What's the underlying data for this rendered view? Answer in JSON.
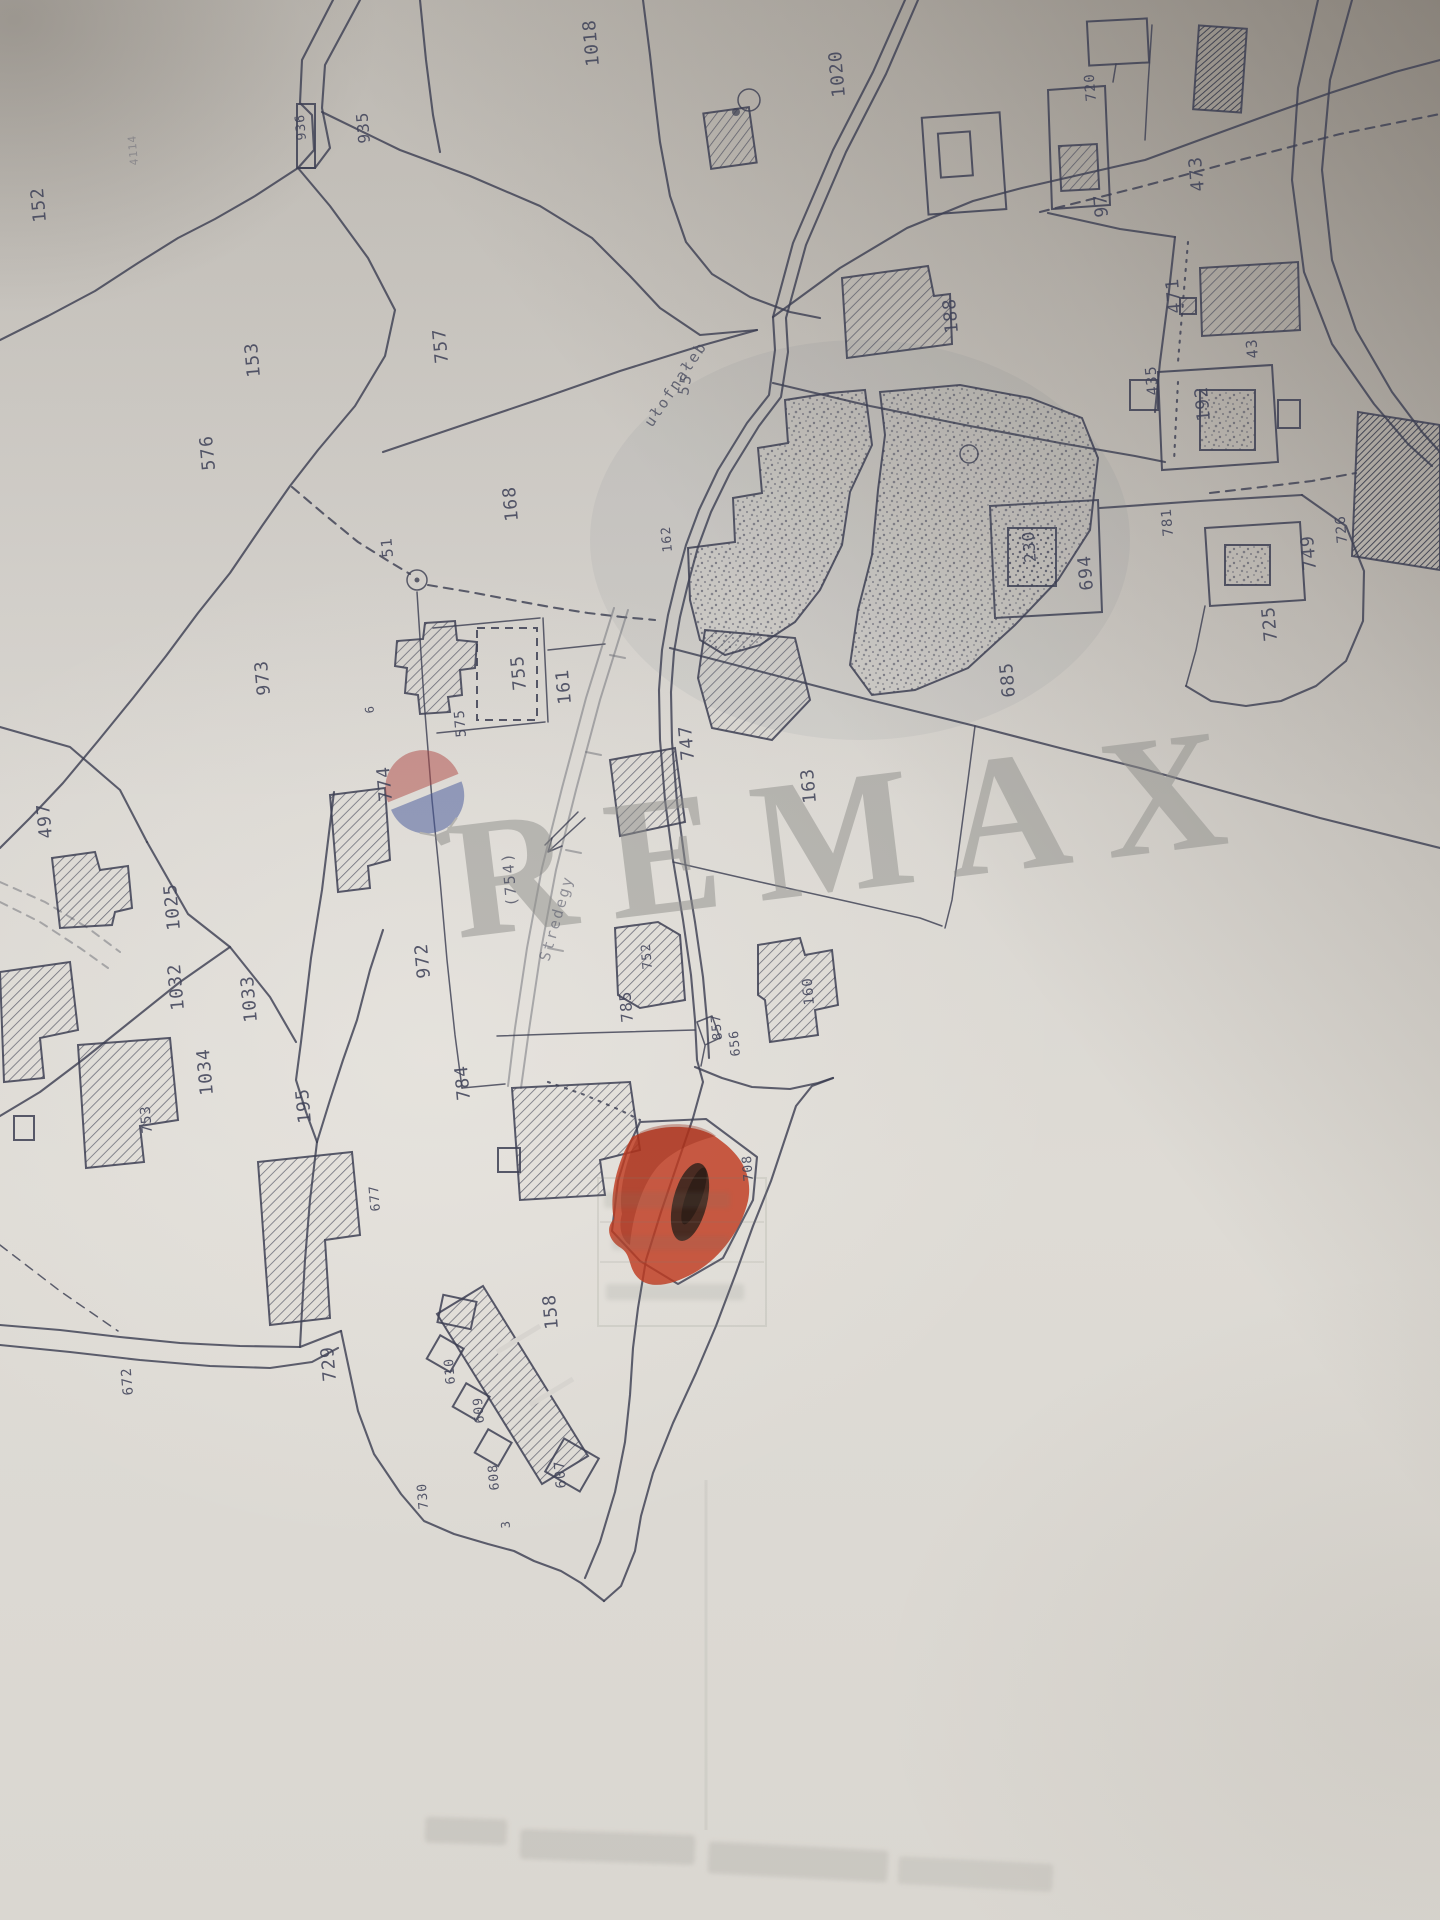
{
  "meta": {
    "description": "Photographed black-and-white cadastral parcel map with one parcel highlighted in red marker and a RE/MAX watermark"
  },
  "watermark": {
    "brand": "REMAX",
    "text_color": "#8f8f8b",
    "balloon": {
      "top_color": "#b04a46",
      "bottom_color": "#45589b",
      "basket_color": "#8a8a86"
    }
  },
  "map": {
    "paper_color": "#d7d4cf",
    "ink_color": "#3d4053",
    "pencil_color": "#6b6d76",
    "highlight_color": "#bf3a20",
    "highlighted_parcel_label": "708",
    "streets": [
      {
        "name": "ułofnałeb",
        "x": 652,
        "y": 428,
        "rotate": -56,
        "pencil": false
      },
      {
        "name": "55",
        "x": 688,
        "y": 396,
        "rotate": -80,
        "pencil": false
      },
      {
        "name": "Stredegy",
        "x": 549,
        "y": 962,
        "rotate": -74,
        "pencil": true
      },
      {
        "name": "(754)",
        "x": 517,
        "y": 906,
        "rotate": -95,
        "pencil": false
      }
    ],
    "parcel_labels": [
      {
        "t": "152",
        "x": 46,
        "y": 222
      },
      {
        "t": "4114",
        "x": 138,
        "y": 165,
        "s": 11,
        "faint": true
      },
      {
        "t": "936",
        "x": 306,
        "y": 140,
        "s": 13
      },
      {
        "t": "935",
        "x": 370,
        "y": 143,
        "s": 16
      },
      {
        "t": "1018",
        "x": 599,
        "y": 66
      },
      {
        "t": "1020",
        "x": 845,
        "y": 97
      },
      {
        "t": "153",
        "x": 260,
        "y": 377
      },
      {
        "t": "757",
        "x": 448,
        "y": 363
      },
      {
        "t": "168",
        "x": 518,
        "y": 521
      },
      {
        "t": "51",
        "x": 393,
        "y": 557,
        "s": 15
      },
      {
        "t": "576",
        "x": 215,
        "y": 470
      },
      {
        "t": "973",
        "x": 270,
        "y": 695
      },
      {
        "t": "755",
        "x": 526,
        "y": 690
      },
      {
        "t": "575",
        "x": 466,
        "y": 737,
        "s": 14
      },
      {
        "t": "161",
        "x": 571,
        "y": 704
      },
      {
        "t": "6",
        "x": 374,
        "y": 713,
        "s": 12
      },
      {
        "t": "774",
        "x": 392,
        "y": 801
      },
      {
        "t": "497",
        "x": 52,
        "y": 838
      },
      {
        "t": "1025",
        "x": 180,
        "y": 930
      },
      {
        "t": "972",
        "x": 430,
        "y": 978
      },
      {
        "t": "1032",
        "x": 184,
        "y": 1010
      },
      {
        "t": "1033",
        "x": 257,
        "y": 1022
      },
      {
        "t": "1034",
        "x": 213,
        "y": 1095
      },
      {
        "t": "195",
        "x": 311,
        "y": 1123
      },
      {
        "t": "753",
        "x": 152,
        "y": 1133,
        "s": 14
      },
      {
        "t": "784",
        "x": 470,
        "y": 1100
      },
      {
        "t": "785",
        "x": 633,
        "y": 1022,
        "s": 16
      },
      {
        "t": "857",
        "x": 722,
        "y": 1040,
        "s": 13
      },
      {
        "t": "656",
        "x": 740,
        "y": 1056,
        "s": 13
      },
      {
        "t": "160",
        "x": 814,
        "y": 1005,
        "s": 14
      },
      {
        "t": "752",
        "x": 652,
        "y": 969,
        "s": 13
      },
      {
        "t": "747",
        "x": 694,
        "y": 760
      },
      {
        "t": "163",
        "x": 816,
        "y": 803
      },
      {
        "t": "162",
        "x": 672,
        "y": 552,
        "s": 13
      },
      {
        "t": "230",
        "x": 1036,
        "y": 562,
        "s": 16
      },
      {
        "t": "694",
        "x": 1093,
        "y": 590
      },
      {
        "t": "685",
        "x": 1015,
        "y": 697
      },
      {
        "t": "188",
        "x": 958,
        "y": 333
      },
      {
        "t": "97",
        "x": 1108,
        "y": 217
      },
      {
        "t": "720",
        "x": 1096,
        "y": 101,
        "s": 14
      },
      {
        "t": "473",
        "x": 1204,
        "y": 191
      },
      {
        "t": "471",
        "x": 1181,
        "y": 313
      },
      {
        "t": "43",
        "x": 1258,
        "y": 358,
        "s": 15
      },
      {
        "t": "435",
        "x": 1158,
        "y": 395,
        "s": 15
      },
      {
        "t": "192",
        "x": 1210,
        "y": 421
      },
      {
        "t": "749",
        "x": 1316,
        "y": 570
      },
      {
        "t": "725",
        "x": 1277,
        "y": 641
      },
      {
        "t": "726",
        "x": 1347,
        "y": 543,
        "s": 14
      },
      {
        "t": "781",
        "x": 1173,
        "y": 536,
        "s": 14
      },
      {
        "t": "158",
        "x": 558,
        "y": 1329
      },
      {
        "t": "729",
        "x": 336,
        "y": 1381
      },
      {
        "t": "610",
        "x": 455,
        "y": 1384,
        "s": 13
      },
      {
        "t": "609",
        "x": 484,
        "y": 1423,
        "s": 13
      },
      {
        "t": "608",
        "x": 499,
        "y": 1490,
        "s": 13
      },
      {
        "t": "607",
        "x": 566,
        "y": 1488,
        "s": 14
      },
      {
        "t": "730",
        "x": 428,
        "y": 1509,
        "s": 13
      },
      {
        "t": "3",
        "x": 510,
        "y": 1528,
        "s": 12
      },
      {
        "t": "672",
        "x": 133,
        "y": 1395,
        "s": 14
      },
      {
        "t": "677",
        "x": 380,
        "y": 1211,
        "s": 13
      },
      {
        "t": "708",
        "x": 753,
        "y": 1181,
        "s": 13
      }
    ]
  }
}
